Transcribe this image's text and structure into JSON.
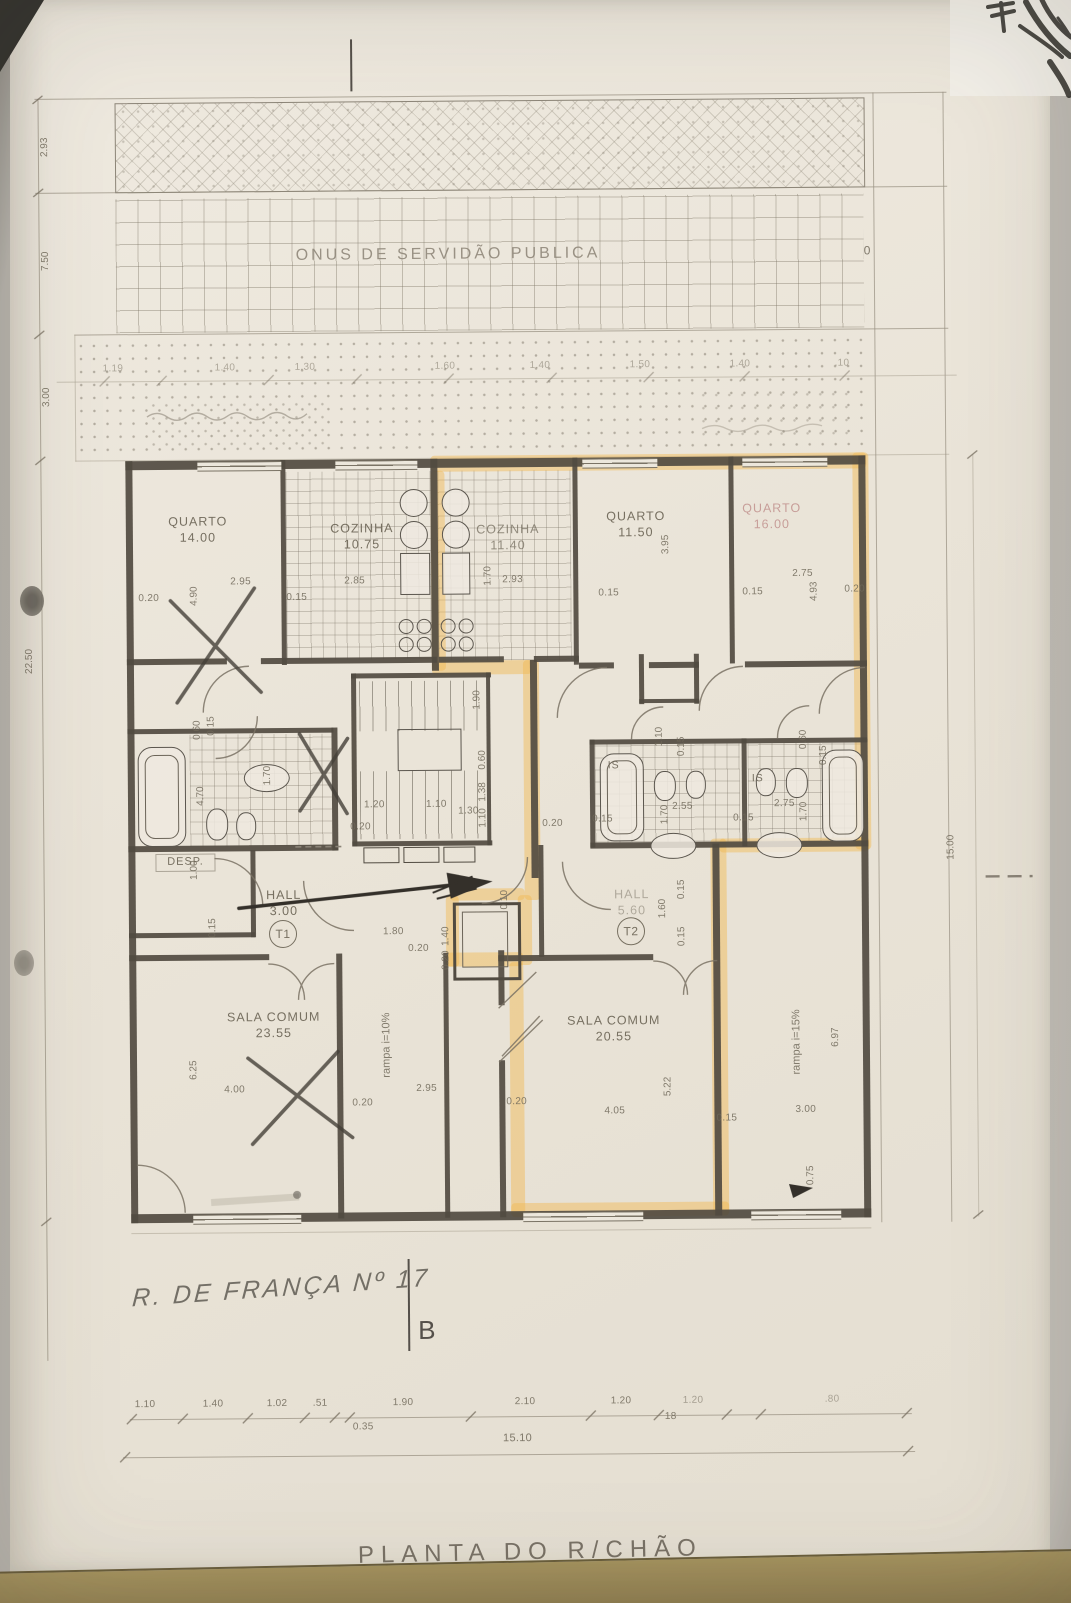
{
  "strips": {
    "servidao_label": "ONUS DE SERVIDÃO PUBLICA",
    "dim_top": "2.93",
    "dim_mid": "7.50",
    "dim_low": "3.00",
    "top_row": [
      "1.19",
      "1.40",
      "1.30",
      "1.60",
      "1.40",
      "1.50",
      "1.40",
      ".10"
    ]
  },
  "site": {
    "dim_left": "22.50",
    "dim_right": "15.00",
    "marker_zero": "0"
  },
  "rooms": {
    "quarto1": {
      "name": "QUARTO",
      "area": "14.00"
    },
    "cozinha1": {
      "name": "COZINHA",
      "area": "10.75"
    },
    "cozinha2": {
      "name": "COZINHA",
      "area": "11.40"
    },
    "quarto2": {
      "name": "QUARTO",
      "area": "11.50"
    },
    "quarto3": {
      "name": "QUARTO",
      "area": "16.00"
    },
    "desp": {
      "name": "DESP."
    },
    "hall1": {
      "name": "HALL",
      "area": "3.00",
      "tag": "T1"
    },
    "hall2": {
      "name": "HALL",
      "area": "5.60",
      "tag": "T2"
    },
    "sala1": {
      "name": "SALA COMUM",
      "area": "23.55"
    },
    "sala2": {
      "name": "SALA COMUM",
      "area": "20.55"
    },
    "is1": {
      "name": "IS"
    },
    "is2": {
      "name": "IS"
    },
    "rampa1": {
      "name": "rampa i=10%"
    },
    "rampa2": {
      "name": "rampa i=15%"
    }
  },
  "dims": {
    "d01": "0.20",
    "d02": "2.95",
    "d03": "4.90",
    "d04": "0.15",
    "d05": "2.85",
    "d06": "1.70",
    "d07": "2.93",
    "d08": "0.15",
    "d09": "3.95",
    "d10": "2.75",
    "d11": "0.15",
    "d12": "0.20",
    "d13": "4.93",
    "d14": "0.60",
    "d15": "0.15",
    "d16": "4.70",
    "d17": "1.70",
    "d18": "1.90",
    "d19": "0.60",
    "d20": "1.38",
    "d21": "1.10",
    "d22": "1.20",
    "d23": "1.10",
    "d24": "1.30",
    "d25": "0.20",
    "d26": "0.20",
    "d27": "1.10",
    "d28": "0.15",
    "d29": "0.60",
    "d30": "0.15",
    "d31": "2.55",
    "d32": "1.70",
    "d33": "2.75",
    "d34": "1.70",
    "d35": "0.15",
    "d36": "0.15",
    "d37": "1.00",
    "d38": "0.15",
    "d39": "1.80",
    "d40": "0.20",
    "d41": "1.40",
    "d42": "0.20",
    "d43": "0.10",
    "d44": "1.60",
    "d45": "0.15",
    "d46": "0.15",
    "d47": "6.25",
    "d48": "4.00",
    "d49": "2.95",
    "d50": "0.20",
    "d51": "0.20",
    "d52": "4.05",
    "d53": "5.22",
    "d54": "0.15",
    "d55": "3.00",
    "d56": "6.97",
    "d57": "0.75"
  },
  "bottom": {
    "row": [
      "1.10",
      "1.40",
      "1.02",
      ".51",
      "1.90",
      "2.10",
      "1.20",
      "1.20",
      ".80"
    ],
    "sub": [
      "0.35",
      "18"
    ],
    "total": "15.10",
    "section": "B"
  },
  "annotations": {
    "street": "R. DE FRANÇA Nº 17",
    "title": "PLANTA DO R/CHÃO"
  }
}
